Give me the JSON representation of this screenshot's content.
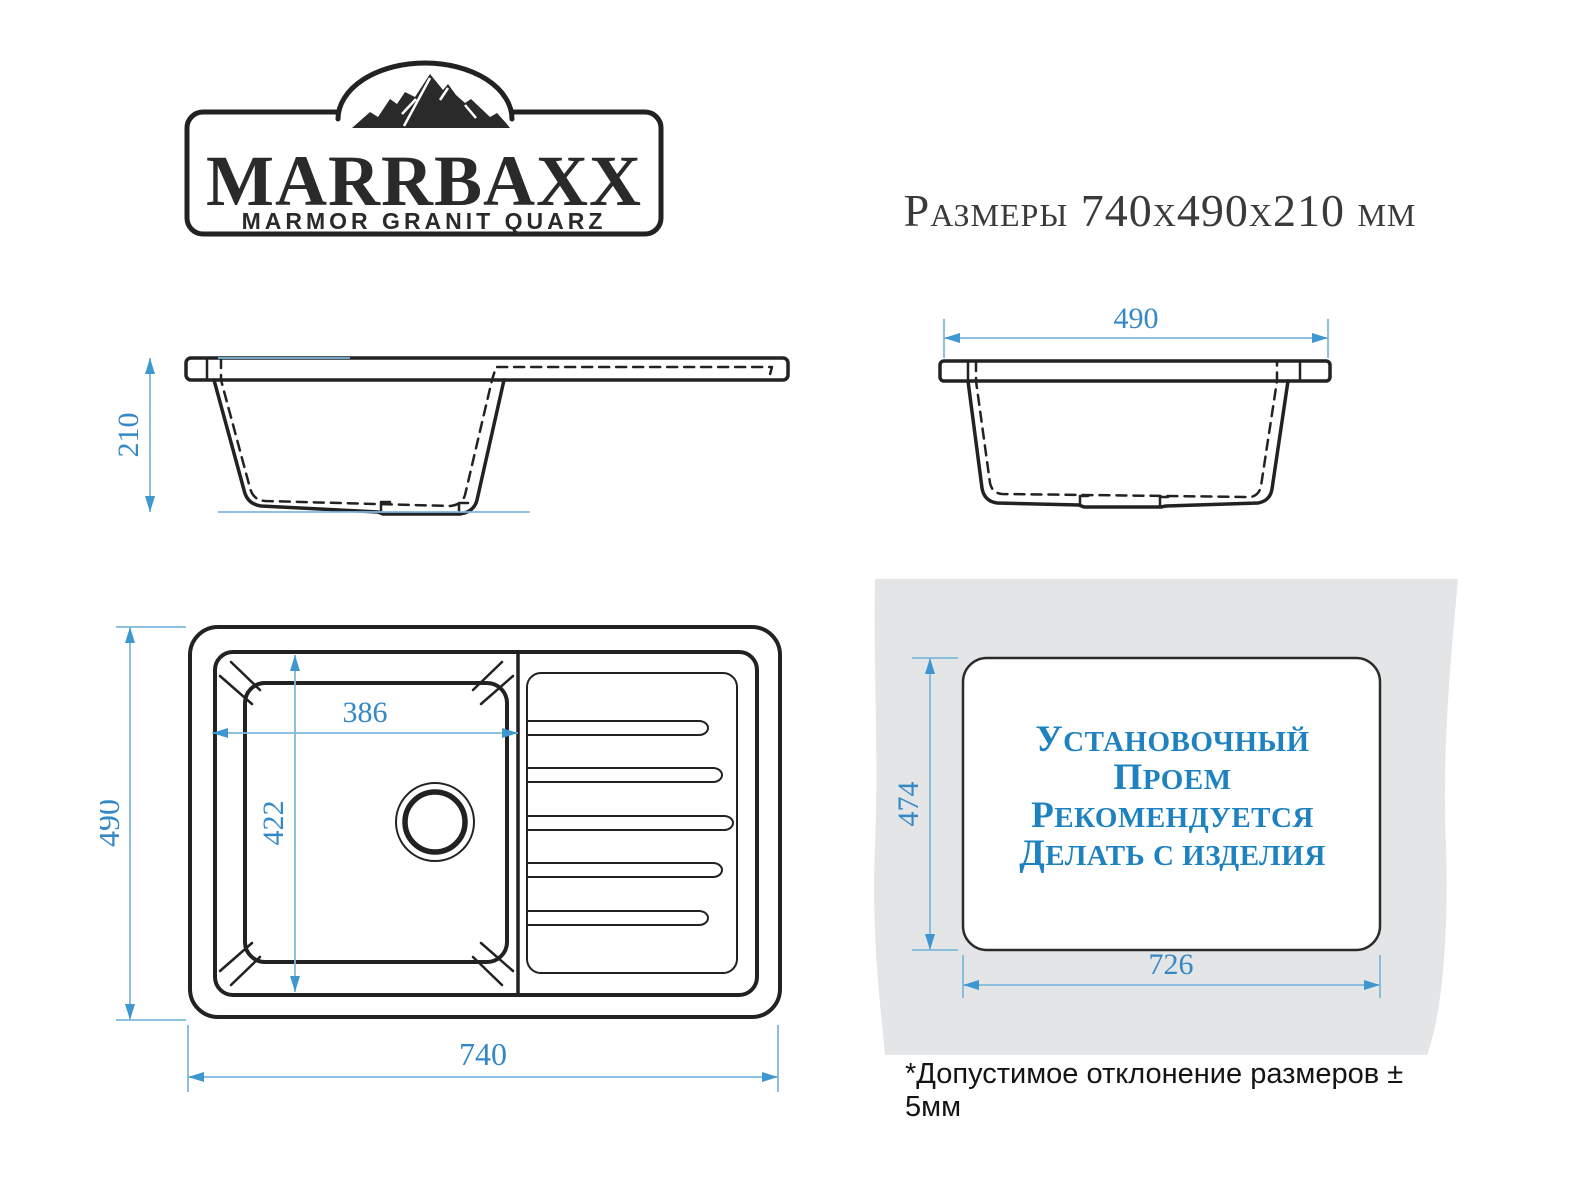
{
  "brand": {
    "name": "MARRBAXX",
    "tagline": "MARMOR GRANIT QUARZ"
  },
  "title": "Размеры 740x490x210 мм",
  "front_view": {
    "depth_mm": "210"
  },
  "side_view": {
    "width_mm": "490"
  },
  "top_view": {
    "length_mm": "740",
    "width_mm": "490",
    "bowl_length_mm": "386",
    "bowl_width_mm": "422"
  },
  "cutout_view": {
    "height_mm": "474",
    "width_mm": "726",
    "note_lines": [
      "УСТАНОВОЧНЫЙ",
      "ПРОЕМ",
      "РЕКОМЕНДУЕТСЯ",
      "ДЕЛАТЬ С ИЗДЕЛИЯ"
    ]
  },
  "footnote": "*Допустимое отклонение размеров  ± 5мм",
  "colors": {
    "drawing_line": "#222222",
    "dimension_line": "#7fb8dc",
    "dimension_arrow": "#3f97d0",
    "dimension_text": "#3488c6",
    "cutout_text": "#1e82c0",
    "countertop_gray": "#e3e5e6",
    "background": "#ffffff"
  }
}
